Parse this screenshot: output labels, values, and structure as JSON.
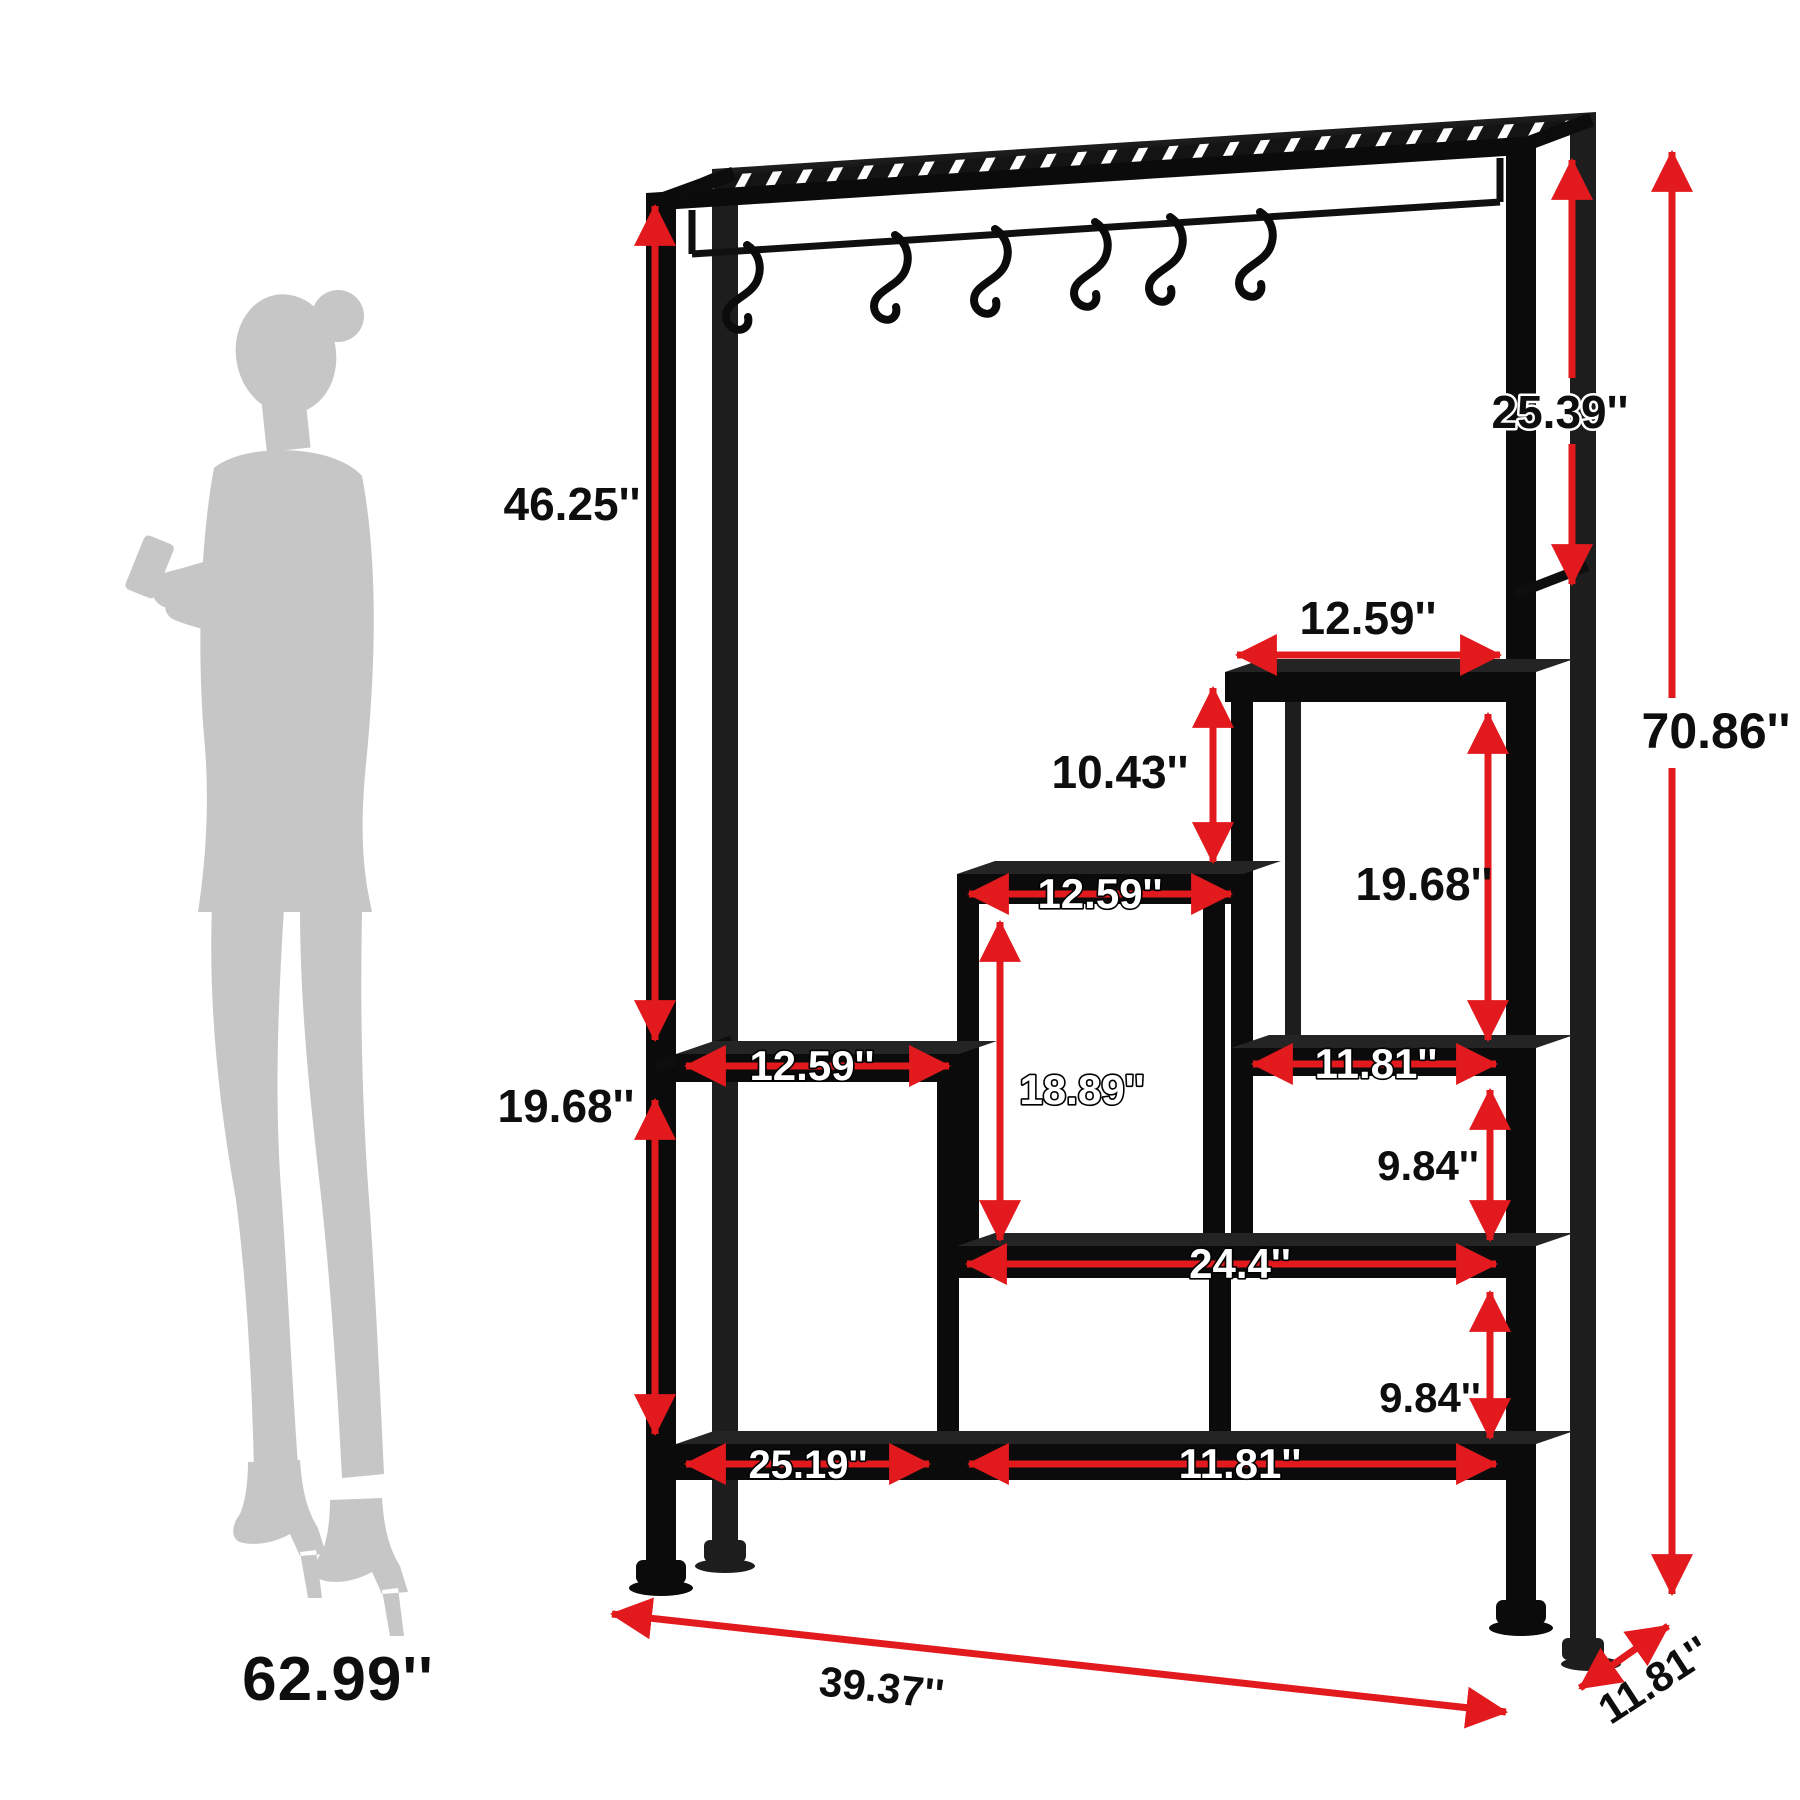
{
  "figure_type": "product dimension diagram",
  "product": "tall open bookshelf / plant stand with top hanging rail and 6 S-hooks",
  "units": "inches",
  "colors": {
    "dimension_red": "#e2191d",
    "frame_black": "#0b0b0b",
    "silhouette_gray": "#c6c6c6",
    "background": "#ffffff"
  },
  "person": {
    "height": "62.99''"
  },
  "dims": {
    "upper_section_height": "46.25''",
    "lower_left_section_height": "19.68''",
    "hook_bay_height": "25.39''",
    "overall_height": "70.86''",
    "top_shelf_width": "12.59''",
    "top_step_rise": "10.43''",
    "right_upper_opening_height": "19.68''",
    "middle_shelf_width": "12.59''",
    "left_shelf_width": "12.59''",
    "middle_opening_height": "18.89''",
    "right_shelf_width": "11.81''",
    "right_upper_gap": "9.84''",
    "long_shelf_width": "24.4''",
    "right_lower_gap": "9.84''",
    "bottom_left_width": "25.19''",
    "bottom_right_width": "11.81''",
    "overall_width": "39.37''",
    "overall_depth": "11.81''"
  },
  "icons": [
    "s-hook-icon",
    "dimension-arrow"
  ]
}
